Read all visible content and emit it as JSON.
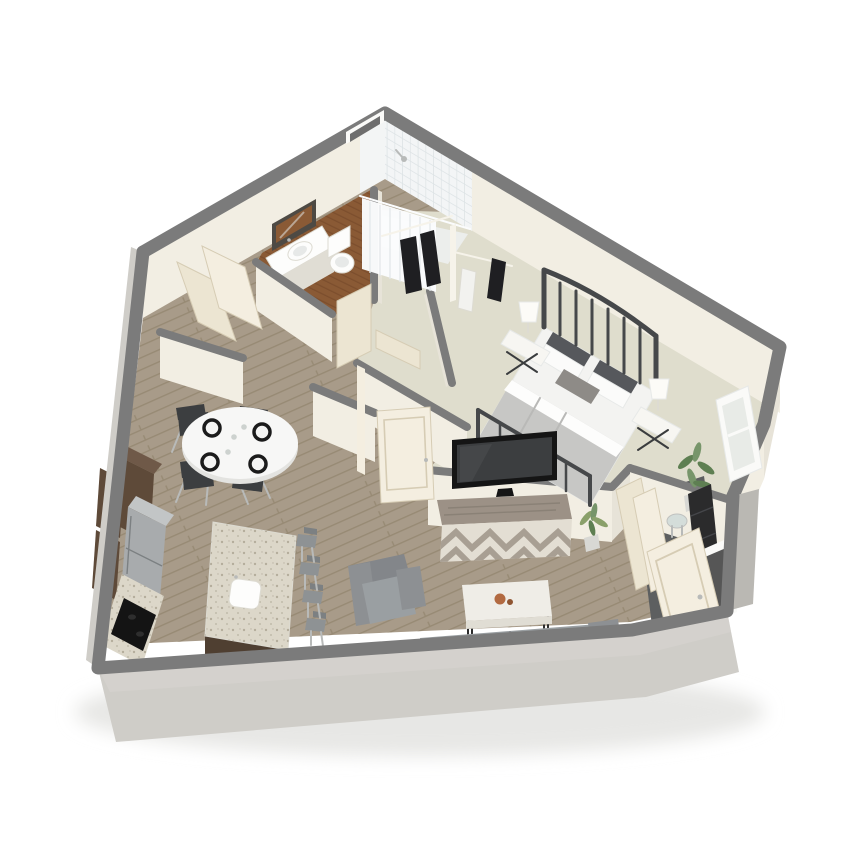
{
  "meta": {
    "kind": "3d-isometric-floor-plan-render",
    "description": "Cutaway 3D floor plan of a one-bedroom apartment on a white background",
    "canvas": {
      "width": 844,
      "height": 844
    }
  },
  "palette": {
    "background": "#ffffff",
    "ground_shadow": "#e7e7e5",
    "wall_cap": "#7b7b7b",
    "wall_cream": "#f2eee3",
    "wall_cream_dim": "#e7e3d8",
    "wall_exterior": "#cfcdc8",
    "wall_exterior_dark": "#bab8b3",
    "floor_wood": "#a89b89",
    "floor_wood_line": "#93866f",
    "floor_carpet": "#dfddcd",
    "floor_bath": "#8a5a35",
    "floor_bath_line": "#76492a",
    "floor_shower": "#eceeec",
    "floor_entry": "#5d5f60",
    "tile": "#f3f5f6",
    "tile_line": "#dde3e5",
    "curtain": "#fbfcfd",
    "curtain_fold": "#e3e8ea",
    "door_cream": "#ece5d2",
    "door_cream_lit": "#f4eee0",
    "door_edge": "#d6ccb4",
    "cabinet_dark": "#5e4a39",
    "cabinet_dark_top": "#6f5948",
    "island_base": "#4f3f31",
    "fridge": "#a8abad",
    "fridge_top": "#c2c5c6",
    "granite": "#dcd7c9",
    "granite_speck": "#948b77",
    "cooktop": "#141414",
    "stool": "#8e9294",
    "stool_back": "#7c8082",
    "metal_leg": "#b8bab9",
    "dining_table": "#f7f7f6",
    "dining_table_shadow": "#e3e3e0",
    "chair_dark": "#3c3e40",
    "plate_rim": "#1b1b1b",
    "plate_center": "#f4f4f3",
    "glassware": "#cdd2cf",
    "sofa": "#9a9fa2",
    "sofa_back": "#83868a",
    "sofa_arm": "#8d9093",
    "coffee_table": "#efede7",
    "coffee_table_edge": "#e0ddd4",
    "coffee_leg": "#2b2b2b",
    "decor_orange": "#b26a41",
    "tv_frame": "#151515",
    "tv_screen": "#3c3e40",
    "dresser_top": "#9c9186",
    "dresser_streak": "#8a8176",
    "dresser_front": "#e3ded3",
    "chevron": "#a89f93",
    "bed_frame": "#46484a",
    "mattress": "#f3f3f1",
    "blanket": "#c7c7c5",
    "blanket_fold": "#b9b9b7",
    "sheet": "#fdfdfc",
    "pillow_dark": "#56585c",
    "pillow_white": "#fbfbfa",
    "pillow_accent": "#8e8b87",
    "nightstand": "#f7f6f2",
    "nightstand_leg": "#3a3c3e",
    "lamp": "#fcfbf7",
    "clothes_dark": "#1f1f22",
    "clothes_light": "#f2f2ef",
    "closet_white": "#f6f3ea",
    "plant_green": "#5e7f52",
    "plant_green_light": "#77956a",
    "plant_yellow_green": "#8aa06a",
    "pot": "#d8d8d4",
    "window_frame": "#fafaf8",
    "window_glass": "#e8ebe7",
    "mirror_frame": "#4e4a44",
    "mirror_wood": "#8a5a35",
    "porcelain": "#fdfdfc",
    "porcelain_shadow": "#e7e9e8",
    "porcelain_edge": "#dddbd2",
    "shelf_black": "#2b2b2c",
    "shelf_slat": "#45464a",
    "glass_table": "#cfdbd9",
    "doorway_dark": "#565656",
    "window_slot_dark": "#6e6e6e"
  },
  "scene": {
    "view": "isometric cutaway from above",
    "rooms": [
      {
        "name": "kitchen",
        "floor": "wood plank"
      },
      {
        "name": "dining-area",
        "floor": "wood plank"
      },
      {
        "name": "living-room",
        "floor": "wood plank"
      },
      {
        "name": "hallway",
        "floor": "wood plank"
      },
      {
        "name": "bathroom",
        "floor": "dark hardwood"
      },
      {
        "name": "shower",
        "floor": "light tile"
      },
      {
        "name": "walk-in-closet",
        "floor": "carpet"
      },
      {
        "name": "bedroom",
        "floor": "carpet"
      },
      {
        "name": "entry",
        "floor": "dark slate"
      }
    ],
    "furniture": [
      "round dining table with four place settings and four dark chairs",
      "kitchen wall cabinets, tall pantry, refrigerator, cooktop counter",
      "granite kitchen island with sink and four bar stools",
      "gray sofa, gray armchair, marble coffee table with decor bowl",
      "media dresser with chevron front and wall-mounted TV",
      "queen bed with metal frame, gray bedding and pillows",
      "two nightstands with white lamps",
      "corner window with potted plant",
      "walk-in closet with hanging clothes",
      "bathroom vanity with sink and mirror, toilet",
      "tiled shower with white curtain",
      "entry with open door, black shelf unit and glass side table"
    ]
  }
}
